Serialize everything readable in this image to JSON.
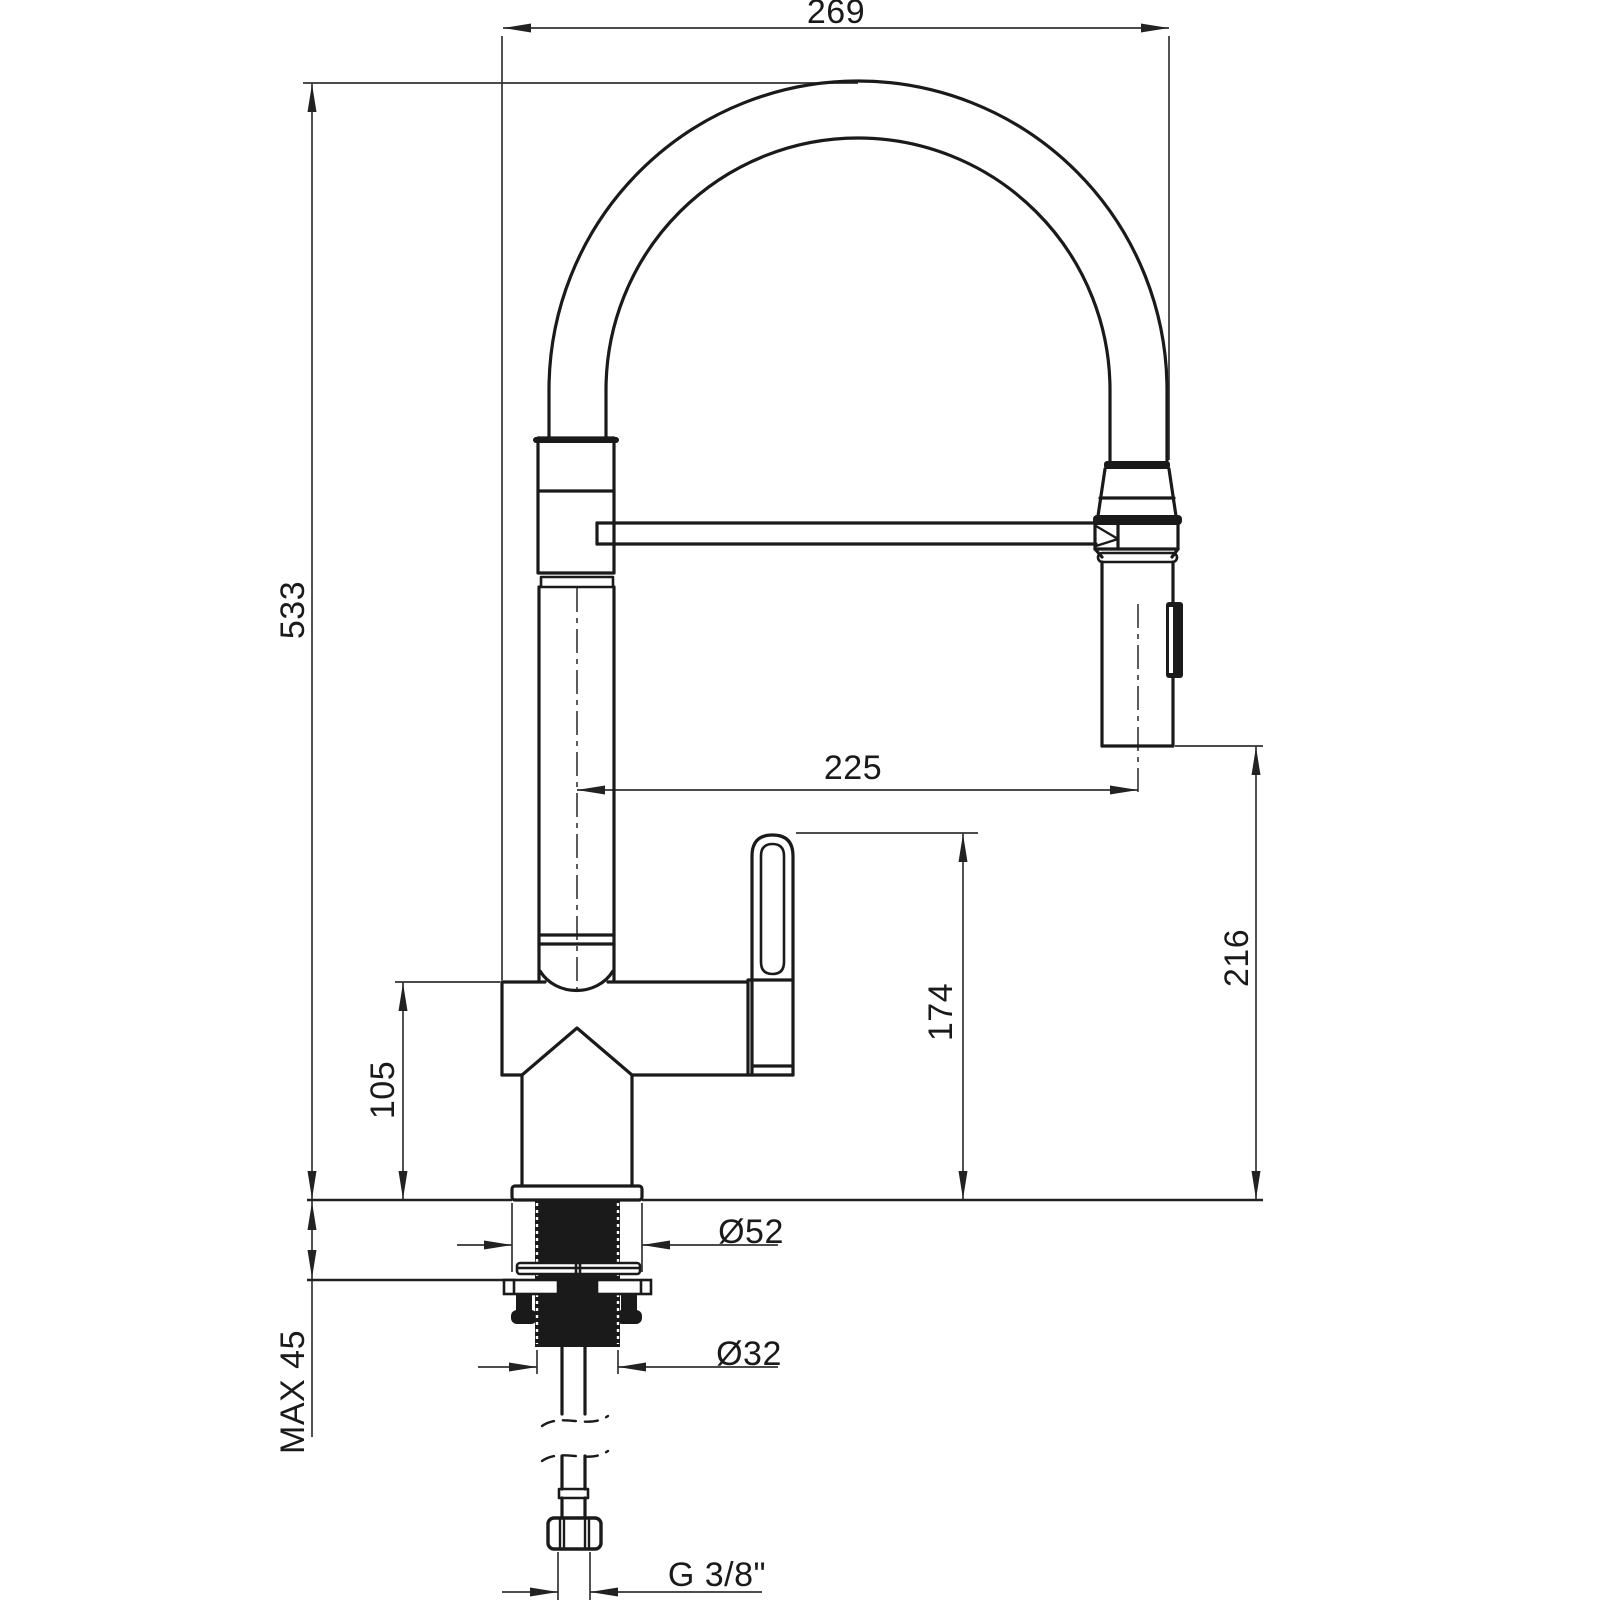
{
  "meta": {
    "drawing_type": "technical dimension drawing",
    "subject": "single-lever kitchen mixer tap with flexible spring spout and pull-down spray head, mounted through a countertop",
    "background_color": "#ffffff",
    "line_color": "#1a1a1a",
    "dimension_line_color": "#333333"
  },
  "dimensions": {
    "overall_depth": "269",
    "overall_height": "533",
    "spout_reach": "225",
    "spray_outlet_height": "216",
    "lever_top_height": "174",
    "body_top_height": "105",
    "flange_diameter": "Ø52",
    "shank_diameter": "Ø32",
    "max_deck_thickness": "MAX 45",
    "supply_connection_thread": "G 3/8\""
  }
}
